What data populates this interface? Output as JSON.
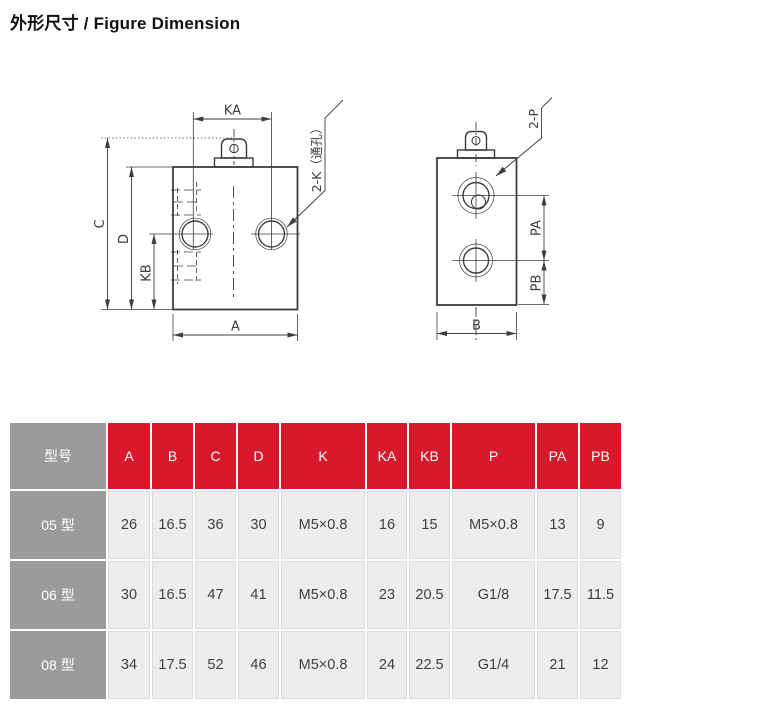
{
  "title": "外形尺寸 / Figure Dimension",
  "drawing": {
    "front_view": {
      "dim_ka": "KA",
      "dim_c": "C",
      "dim_d": "D",
      "dim_kb": "KB",
      "dim_a": "A",
      "callout": "2-K（通孔）"
    },
    "side_view": {
      "dim_pa": "PA",
      "dim_pb": "PB",
      "dim_b": "B",
      "callout": "2-P"
    }
  },
  "table": {
    "header": [
      "型号",
      "A",
      "B",
      "C",
      "D",
      "K",
      "KA",
      "KB",
      "P",
      "PA",
      "PB"
    ],
    "rows": [
      {
        "model": "05 型",
        "values": [
          "26",
          "16.5",
          "36",
          "30",
          "M5×0.8",
          "16",
          "15",
          "M5×0.8",
          "13",
          "9"
        ]
      },
      {
        "model": "06 型",
        "values": [
          "30",
          "16.5",
          "47",
          "41",
          "M5×0.8",
          "23",
          "20.5",
          "G1/8",
          "17.5",
          "11.5"
        ]
      },
      {
        "model": "08 型",
        "values": [
          "34",
          "17.5",
          "52",
          "46",
          "M5×0.8",
          "24",
          "22.5",
          "G1/4",
          "21",
          "12"
        ]
      }
    ],
    "colors": {
      "header_red": "#D8192C",
      "model_gray": "#9B9B9B",
      "cell_bg": "#EDEDED",
      "header_text": "#FFFFFF",
      "cell_text": "#3F3F3F"
    }
  }
}
